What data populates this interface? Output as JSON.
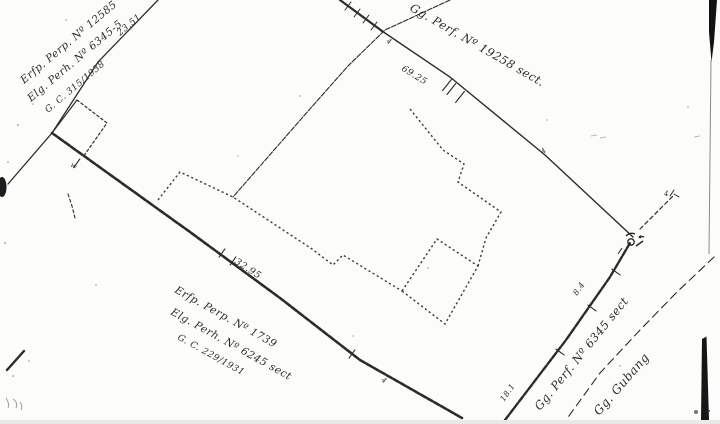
{
  "page": {
    "description_colors": {
      "paper": "#fcfcfb",
      "ink": "#2e2b27",
      "artifact_black": "#141414"
    }
  },
  "annotations": {
    "top_left_block": {
      "line1": "Erfp. Perp. Nº 12585",
      "line2": "Elg. Perh. Nº 6345-5",
      "line3": "G. C. 315/1938"
    },
    "top_right_label": "Gg. Perf. Nº 19258 sect.",
    "bottom_left_block": {
      "line1": "Erfp. Perp. Nº 1739",
      "line2": "Elg. Perh. Nº 6245 sect",
      "line3": "G. C. 229/1931"
    },
    "bottom_right_label": "Gg. Perf. Nº 6345 sect",
    "road_label": "Gg. Gubang",
    "quote_mark": "”"
  },
  "measurements": {
    "west_boundary": "23.51",
    "north_boundary": "69.25",
    "south_boundary": "32.95",
    "east_lower": "18.1",
    "east_mid": "8.4"
  },
  "point_marks": {
    "west": "w",
    "crossing": "4",
    "north": "4",
    "south": "4",
    "junction_right": "4"
  }
}
